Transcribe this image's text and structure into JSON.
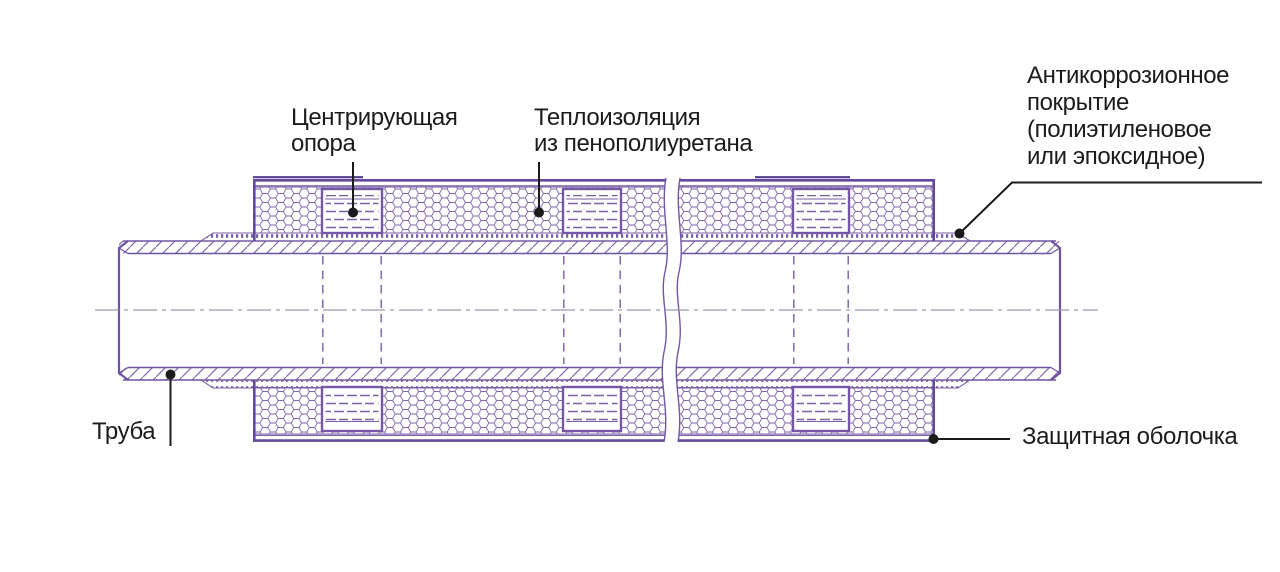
{
  "diagram": {
    "kind": "pre-insulated pipe cross-section",
    "labels": {
      "centering_support": {
        "lines": [
          "Центрирующая",
          "опора"
        ]
      },
      "insulation": {
        "lines": [
          "Теплоизоляция",
          "из пенополиуретана"
        ]
      },
      "anticorrosion": {
        "lines": [
          "Антикоррозионное",
          "покрытие",
          "(полиэтиленовое",
          "или эпоксидное)"
        ]
      },
      "pipe": {
        "text": "Труба"
      },
      "casing": {
        "text": "Защитная оболочка"
      }
    },
    "colors": {
      "line_purple": "#7457a4",
      "line_purple_dark": "#63489b",
      "hatch_purple": "#8468ab",
      "pattern_purple": "#7a5fa5",
      "centerline_gray": "#9d98ac",
      "leader_black": "#1b1b1b",
      "text": "#1c1c1c",
      "background": "#ffffff"
    }
  }
}
